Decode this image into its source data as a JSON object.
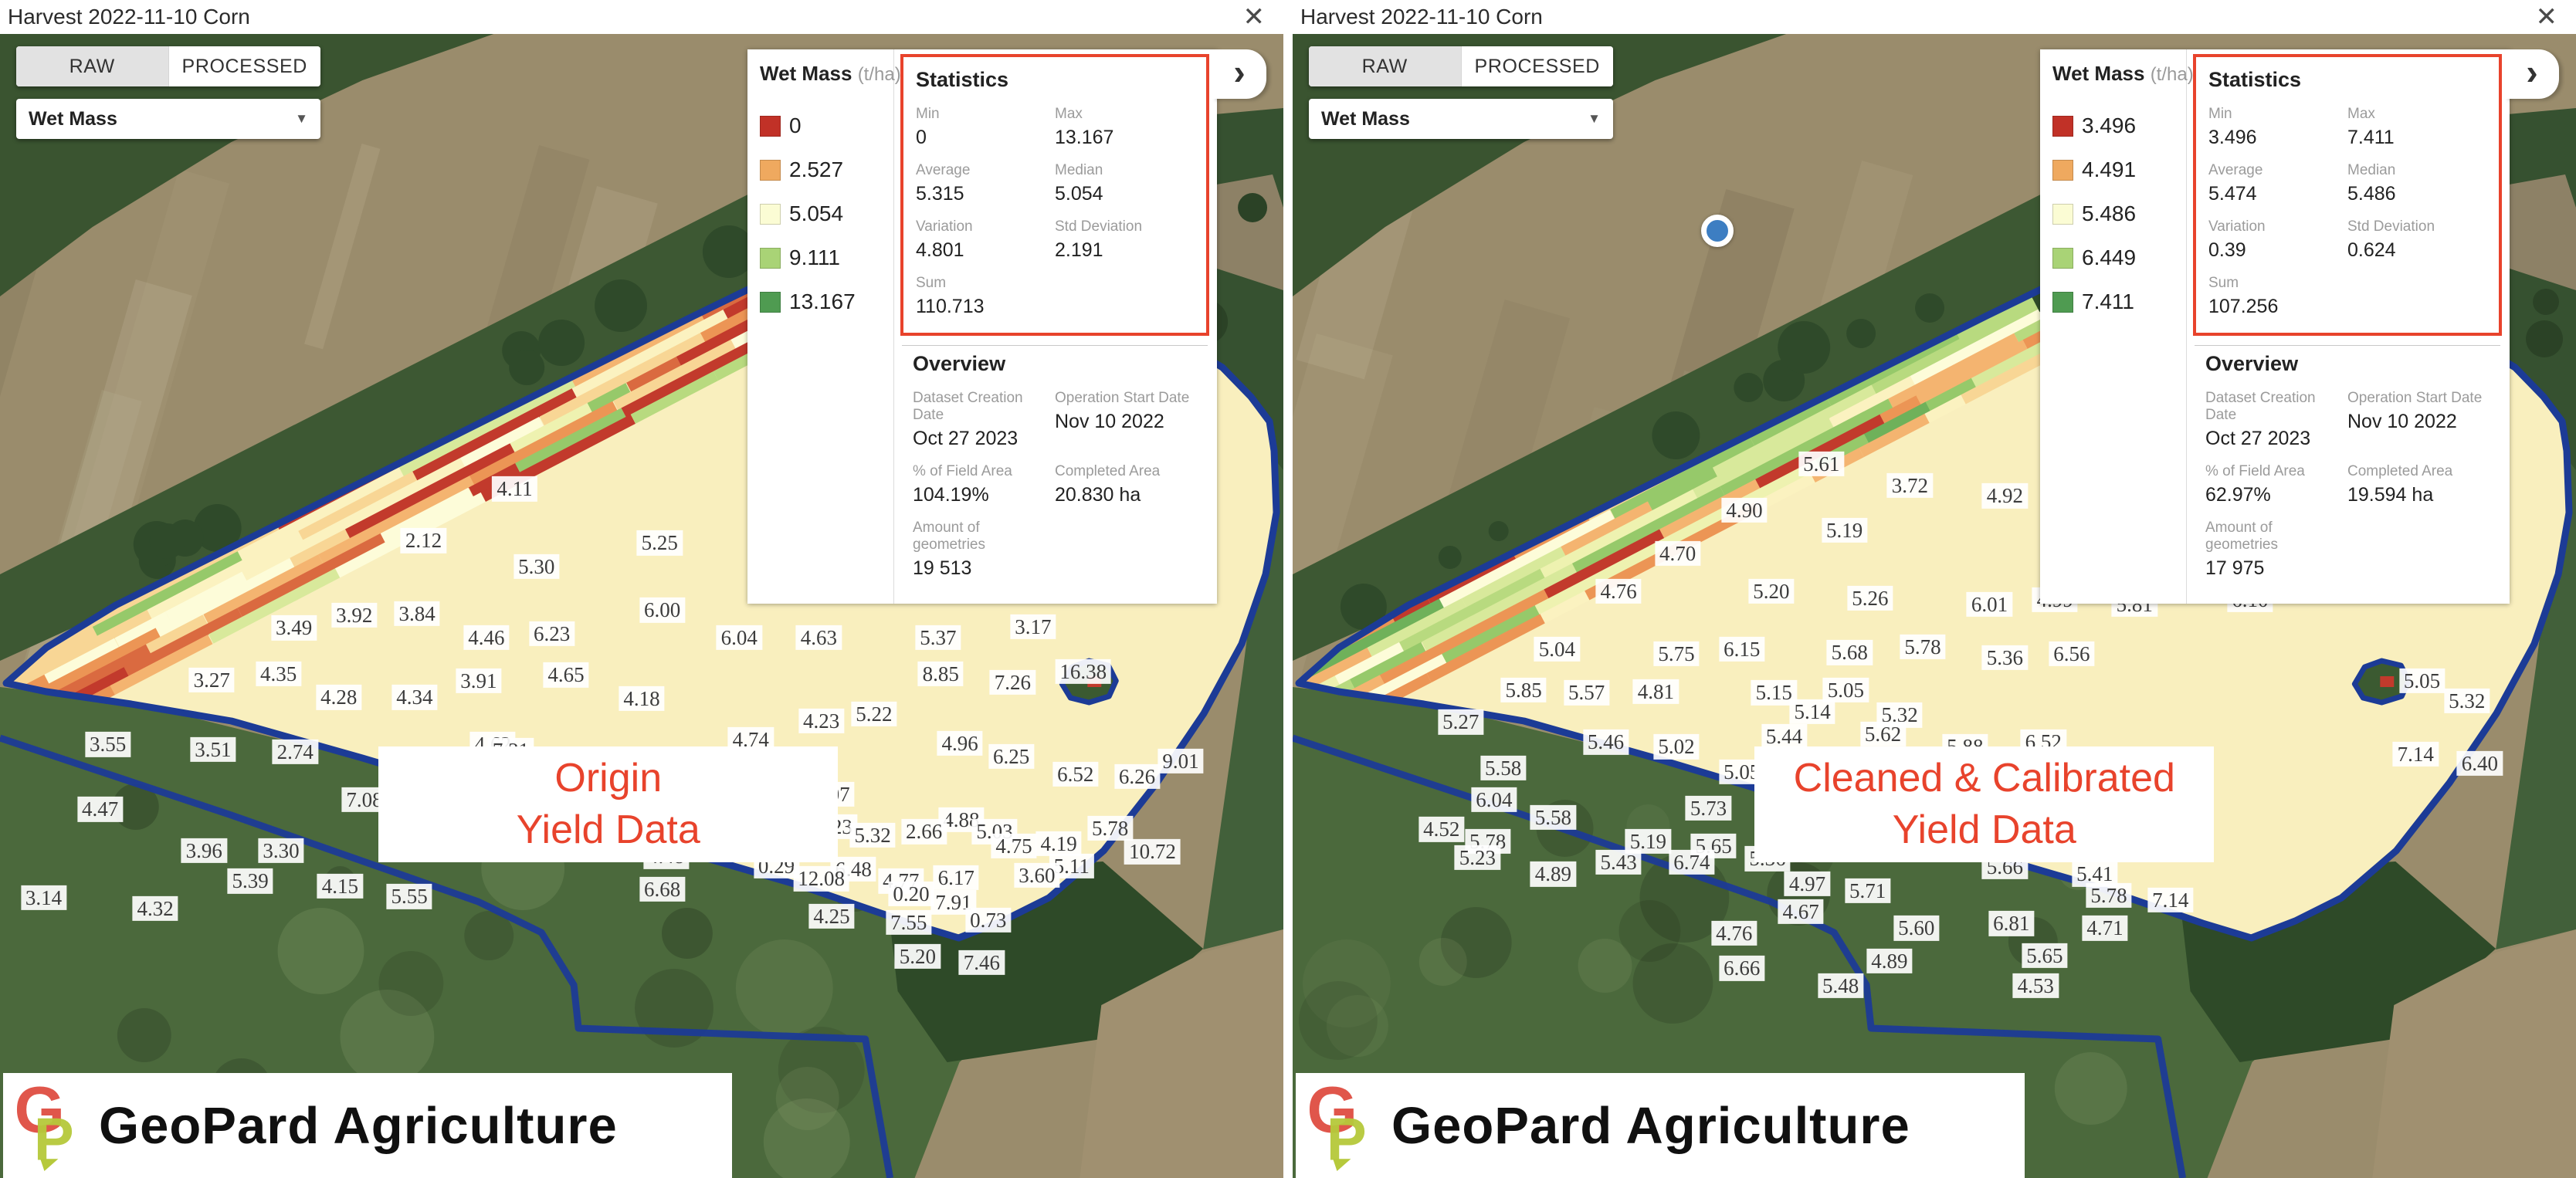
{
  "icons": {
    "close": "✕",
    "chevron": "›",
    "dropdown_arrow": "▼"
  },
  "colors": {
    "accent_red": "#e8432c",
    "boundary_blue": "#1c3b96",
    "marker_blue": "#3d7ec2",
    "legend_red": "#c13127",
    "legend_orange": "#efa95f",
    "legend_yellow": "#fbfcd4",
    "legend_lightgreen": "#a9d376",
    "legend_green": "#4f9b51"
  },
  "logo": {
    "text": "GeoPard Agriculture"
  },
  "panels": [
    {
      "header": {
        "title": "Harvest 2022-11-10 Corn"
      },
      "toggle": {
        "raw_label": "RAW",
        "processed_label": "PROCESSED",
        "selected": "RAW"
      },
      "dropdown": {
        "value": "Wet Mass"
      },
      "legend": {
        "title": "Wet Mass",
        "unit": "(t/ha)",
        "items": [
          {
            "value": "0",
            "color": "#c13127"
          },
          {
            "value": "2.527",
            "color": "#efa95f"
          },
          {
            "value": "5.054",
            "color": "#fbfcd4"
          },
          {
            "value": "9.111",
            "color": "#a9d376"
          },
          {
            "value": "13.167",
            "color": "#4f9b51"
          }
        ]
      },
      "statistics": {
        "title": "Statistics",
        "rows": [
          {
            "label": "Min",
            "value": "0"
          },
          {
            "label": "Max",
            "value": "13.167"
          },
          {
            "label": "Average",
            "value": "5.315"
          },
          {
            "label": "Median",
            "value": "5.054"
          },
          {
            "label": "Variation",
            "value": "4.801"
          },
          {
            "label": "Std Deviation",
            "value": "2.191"
          },
          {
            "label": "Sum",
            "value": "110.713"
          }
        ]
      },
      "overview": {
        "title": "Overview",
        "rows": [
          {
            "label": "Dataset Creation Date",
            "value": "Oct 27 2023"
          },
          {
            "label": "Operation Start Date",
            "value": "Nov 10 2022"
          },
          {
            "label": "% of Field Area",
            "value": "104.19%"
          },
          {
            "label": "Completed Area",
            "value": "20.830 ha"
          },
          {
            "label": "Amount of geometries",
            "value": "19 513"
          }
        ]
      },
      "caption": {
        "lines": [
          "Origin",
          "Yield Data"
        ]
      },
      "location_dot": false,
      "map": {
        "seed": 7,
        "red_streaks": 15,
        "dark_blobs": 8,
        "variant": "raw"
      },
      "map_labels": [
        [
          "4.11",
          40.1,
          41.5
        ],
        [
          "2.12",
          33.0,
          45.9
        ],
        [
          "5.25",
          51.4,
          46.1
        ],
        [
          "5.30",
          41.8,
          48.1
        ],
        [
          "4.69",
          60.1,
          48.2
        ],
        [
          "0.80",
          68.8,
          47.7
        ],
        [
          "2.55",
          74.5,
          48.3
        ],
        [
          "6.00",
          51.6,
          51.8
        ],
        [
          "3.92",
          27.6,
          52.2
        ],
        [
          "3.84",
          32.5,
          52.1
        ],
        [
          "3.49",
          22.9,
          53.3
        ],
        [
          "3.17",
          80.5,
          53.2
        ],
        [
          "6.23",
          43.0,
          53.8
        ],
        [
          "4.46",
          37.9,
          54.1
        ],
        [
          "6.04",
          57.6,
          54.1
        ],
        [
          "4.63",
          63.8,
          54.1
        ],
        [
          "5.37",
          73.1,
          54.1
        ],
        [
          "8.85",
          73.3,
          57.2
        ],
        [
          "7.26",
          78.9,
          57.9
        ],
        [
          "16.38",
          84.4,
          57.0
        ],
        [
          "4.35",
          21.7,
          57.2
        ],
        [
          "3.27",
          16.5,
          57.7
        ],
        [
          "3.91",
          37.3,
          57.8
        ],
        [
          "4.65",
          44.1,
          57.3
        ],
        [
          "4.28",
          26.4,
          59.2
        ],
        [
          "4.34",
          32.3,
          59.2
        ],
        [
          "4.18",
          50.0,
          59.3
        ],
        [
          "5.22",
          68.1,
          60.6
        ],
        [
          "4.23",
          64.0,
          61.2
        ],
        [
          "4.74",
          58.5,
          62.8
        ],
        [
          "4.96",
          74.8,
          63.1
        ],
        [
          "3.55",
          8.4,
          63.2
        ],
        [
          "4.62",
          38.4,
          63.2
        ],
        [
          "3.51",
          16.6,
          63.6
        ],
        [
          "2.74",
          23.0,
          63.8
        ],
        [
          "7.31",
          39.8,
          63.7
        ],
        [
          "6.25",
          78.8,
          64.2
        ],
        [
          "6.42",
          51.8,
          65.2
        ],
        [
          "6.52",
          83.8,
          65.7
        ],
        [
          "6.26",
          88.6,
          65.9
        ],
        [
          "9.01",
          92.0,
          64.6
        ],
        [
          "4.80",
          43.9,
          66.3
        ],
        [
          "4.07",
          64.8,
          67.4
        ],
        [
          "2.37",
          33.5,
          67.5
        ],
        [
          "7.08",
          28.4,
          67.9
        ],
        [
          "5.16",
          47.5,
          68.0
        ],
        [
          "2.12",
          39.0,
          68.6
        ],
        [
          "4.47",
          7.8,
          68.7
        ],
        [
          "4.88",
          74.9,
          69.6
        ],
        [
          "6.23",
          65.0,
          70.2
        ],
        [
          "2.66",
          72.0,
          70.6
        ],
        [
          "5.03",
          77.5,
          70.6
        ],
        [
          "4.67",
          59.7,
          71.0
        ],
        [
          "5.32",
          68.0,
          70.9
        ],
        [
          "5.78",
          86.5,
          70.3
        ],
        [
          "4.19",
          82.5,
          71.6
        ],
        [
          "4.75",
          79.0,
          71.8
        ],
        [
          "10.72",
          89.8,
          72.3
        ],
        [
          "3.96",
          15.9,
          72.2
        ],
        [
          "3.30",
          21.9,
          72.2
        ],
        [
          "3.63",
          44.2,
          72.1
        ],
        [
          "4.48",
          51.9,
          72.7
        ],
        [
          "0.29",
          60.5,
          73.5
        ],
        [
          "6.48",
          66.5,
          73.8
        ],
        [
          "5.11",
          83.5,
          73.5
        ],
        [
          "12.08",
          64.0,
          74.6
        ],
        [
          "4.77",
          70.2,
          74.8
        ],
        [
          "6.17",
          74.5,
          74.5
        ],
        [
          "3.60",
          80.8,
          74.3
        ],
        [
          "5.39",
          19.5,
          74.8
        ],
        [
          "4.15",
          26.5,
          75.2
        ],
        [
          "6.68",
          51.6,
          75.5
        ],
        [
          "0.20",
          71.0,
          75.9
        ],
        [
          "7.91",
          74.3,
          76.6
        ],
        [
          "5.55",
          31.9,
          76.1
        ],
        [
          "3.14",
          3.4,
          76.2
        ],
        [
          "4.32",
          12.1,
          77.1
        ],
        [
          "4.25",
          64.8,
          77.8
        ],
        [
          "7.55",
          70.8,
          78.3
        ],
        [
          "0.73",
          77.0,
          78.1
        ],
        [
          "5.20",
          71.5,
          81.2
        ],
        [
          "7.46",
          76.5,
          81.7
        ]
      ]
    },
    {
      "header": {
        "title": "Harvest 2022-11-10 Corn"
      },
      "toggle": {
        "raw_label": "RAW",
        "processed_label": "PROCESSED",
        "selected": "RAW"
      },
      "dropdown": {
        "value": "Wet Mass"
      },
      "legend": {
        "title": "Wet Mass",
        "unit": "(t/ha)",
        "items": [
          {
            "value": "3.496",
            "color": "#c13127"
          },
          {
            "value": "4.491",
            "color": "#efa95f"
          },
          {
            "value": "5.486",
            "color": "#fbfcd4"
          },
          {
            "value": "6.449",
            "color": "#a9d376"
          },
          {
            "value": "7.411",
            "color": "#4f9b51"
          }
        ]
      },
      "statistics": {
        "title": "Statistics",
        "rows": [
          {
            "label": "Min",
            "value": "3.496"
          },
          {
            "label": "Max",
            "value": "7.411"
          },
          {
            "label": "Average",
            "value": "5.474"
          },
          {
            "label": "Median",
            "value": "5.486"
          },
          {
            "label": "Variation",
            "value": "0.39"
          },
          {
            "label": "Std Deviation",
            "value": "0.624"
          },
          {
            "label": "Sum",
            "value": "107.256"
          }
        ]
      },
      "overview": {
        "title": "Overview",
        "rows": [
          {
            "label": "Dataset Creation Date",
            "value": "Oct 27 2023"
          },
          {
            "label": "Operation Start Date",
            "value": "Nov 10 2022"
          },
          {
            "label": "% of Field Area",
            "value": "62.97%"
          },
          {
            "label": "Completed Area",
            "value": "19.594 ha"
          },
          {
            "label": "Amount of geometries",
            "value": "17 975"
          }
        ]
      },
      "caption": {
        "lines": [
          "Cleaned & Calibrated",
          "Yield Data"
        ]
      },
      "location_dot": true,
      "map": {
        "seed": 99,
        "red_streaks": 5,
        "dark_blobs": 36,
        "variant": "clean"
      },
      "map_labels": [
        [
          "5.61",
          41.2,
          39.4
        ],
        [
          "3.72",
          48.1,
          41.2
        ],
        [
          "4.92",
          55.5,
          42.1
        ],
        [
          "6.34",
          63.0,
          42.9
        ],
        [
          "6.29",
          67.9,
          43.3
        ],
        [
          "4.90",
          35.2,
          43.3
        ],
        [
          "5.19",
          43.0,
          45.0
        ],
        [
          "4.70",
          30.0,
          47.0
        ],
        [
          "4.76",
          25.4,
          50.2
        ],
        [
          "5.20",
          37.3,
          50.2
        ],
        [
          "5.26",
          45.0,
          50.8
        ],
        [
          "6.01",
          54.3,
          51.3
        ],
        [
          "4.99",
          59.4,
          50.9
        ],
        [
          "5.81",
          65.6,
          51.3
        ],
        [
          "6.10",
          74.6,
          50.9
        ],
        [
          "5.04",
          20.6,
          55.1
        ],
        [
          "5.75",
          29.9,
          55.5
        ],
        [
          "6.15",
          35.0,
          55.1
        ],
        [
          "5.68",
          43.4,
          55.4
        ],
        [
          "5.78",
          49.1,
          54.9
        ],
        [
          "5.36",
          55.5,
          55.8
        ],
        [
          "6.56",
          60.7,
          55.5
        ],
        [
          "5.85",
          18.0,
          58.6
        ],
        [
          "5.57",
          22.9,
          58.8
        ],
        [
          "4.81",
          28.3,
          58.7
        ],
        [
          "5.15",
          37.5,
          58.8
        ],
        [
          "5.05",
          43.1,
          58.6
        ],
        [
          "5.05",
          88.0,
          57.8
        ],
        [
          "5.14",
          40.5,
          60.4
        ],
        [
          "5.32",
          47.3,
          60.7
        ],
        [
          "5.32",
          91.5,
          59.5
        ],
        [
          "5.27",
          13.1,
          61.3
        ],
        [
          "5.46",
          24.4,
          63.0
        ],
        [
          "5.02",
          29.9,
          63.4
        ],
        [
          "5.44",
          38.3,
          62.5
        ],
        [
          "5.62",
          46.0,
          62.3
        ],
        [
          "5.88",
          52.4,
          63.4
        ],
        [
          "6.52",
          58.5,
          63.0
        ],
        [
          "5.58",
          16.4,
          65.2
        ],
        [
          "5.05",
          35.0,
          65.5
        ],
        [
          "6.20",
          42.7,
          66.6
        ],
        [
          "7.14",
          87.5,
          64.0
        ],
        [
          "6.40",
          92.5,
          64.8
        ],
        [
          "6.04",
          15.7,
          67.9
        ],
        [
          "5.73",
          32.4,
          68.6
        ],
        [
          "4.41",
          38.9,
          68.9
        ],
        [
          "6.21",
          45.0,
          68.3
        ],
        [
          "5.63",
          50.4,
          67.2
        ],
        [
          "7.14",
          56.9,
          67.2
        ],
        [
          "6.40",
          64.5,
          67.2
        ],
        [
          "5.58",
          20.3,
          69.4
        ],
        [
          "5.78",
          15.2,
          71.4
        ],
        [
          "5.19",
          27.7,
          71.4
        ],
        [
          "5.65",
          32.8,
          71.8
        ],
        [
          "4.19",
          46.5,
          70.8
        ],
        [
          "4.60",
          52.5,
          71.1
        ],
        [
          "4.52",
          11.6,
          70.4
        ],
        [
          "5.23",
          14.4,
          72.8
        ],
        [
          "5.43",
          25.4,
          73.2
        ],
        [
          "6.74",
          31.1,
          73.2
        ],
        [
          "5.36",
          37.0,
          72.9
        ],
        [
          "4.89",
          20.3,
          74.2
        ],
        [
          "4.97",
          40.1,
          75.0
        ],
        [
          "5.71",
          44.8,
          75.6
        ],
        [
          "5.66",
          55.5,
          73.6
        ],
        [
          "5.41",
          62.5,
          74.2
        ],
        [
          "5.78",
          63.6,
          76.0
        ],
        [
          "7.14",
          68.4,
          76.4
        ],
        [
          "4.67",
          39.6,
          77.4
        ],
        [
          "4.76",
          34.4,
          79.2
        ],
        [
          "5.60",
          48.6,
          78.8
        ],
        [
          "6.81",
          56.0,
          78.4
        ],
        [
          "4.71",
          63.3,
          78.8
        ],
        [
          "4.89",
          46.5,
          81.6
        ],
        [
          "5.65",
          58.6,
          81.1
        ],
        [
          "6.66",
          35.0,
          82.2
        ],
        [
          "5.48",
          42.7,
          83.7
        ],
        [
          "4.53",
          57.9,
          83.7
        ]
      ]
    }
  ]
}
